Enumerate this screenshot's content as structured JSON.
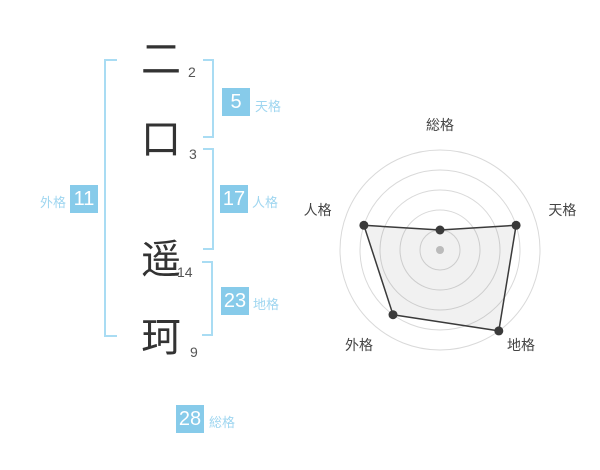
{
  "name": {
    "characters": [
      {
        "char": "二",
        "strokes": "2"
      },
      {
        "char": "口",
        "strokes": "3"
      },
      {
        "char": "遥",
        "strokes": "14"
      },
      {
        "char": "珂",
        "strokes": "9"
      }
    ]
  },
  "gokaku": {
    "tenkaku": {
      "label": "天格",
      "value": "5"
    },
    "jinkaku": {
      "label": "人格",
      "value": "17"
    },
    "chikaku": {
      "label": "地格",
      "value": "23"
    },
    "gaikaku": {
      "label": "外格",
      "value": "11"
    },
    "soukaku": {
      "label": "総格",
      "value": "28"
    }
  },
  "colors": {
    "badge_bg": "#87CBEA",
    "badge_text": "#ffffff",
    "bracket_blue": "#A9DCF3",
    "label_blue": "#9FD6F0",
    "char_color": "#333333",
    "stroke_count_color": "#555555",
    "ring": "#D9D9D9",
    "polygon_stroke": "#3A3A3A",
    "polygon_fill": "rgba(0,0,0,0.055)",
    "dot": "#3A3A3A",
    "center_dot": "#C6C6C6",
    "axis_label": "#444444"
  },
  "chart_data": {
    "type": "radar",
    "categories": [
      "総格",
      "天格",
      "地格",
      "外格",
      "人格"
    ],
    "values": [
      1,
      4,
      5,
      4,
      4
    ],
    "max": 5,
    "rings": 5,
    "outer_radius_px": 100,
    "start_angle_deg": -90,
    "direction": "clockwise",
    "grid": "circular",
    "legend": "none",
    "title": ""
  }
}
